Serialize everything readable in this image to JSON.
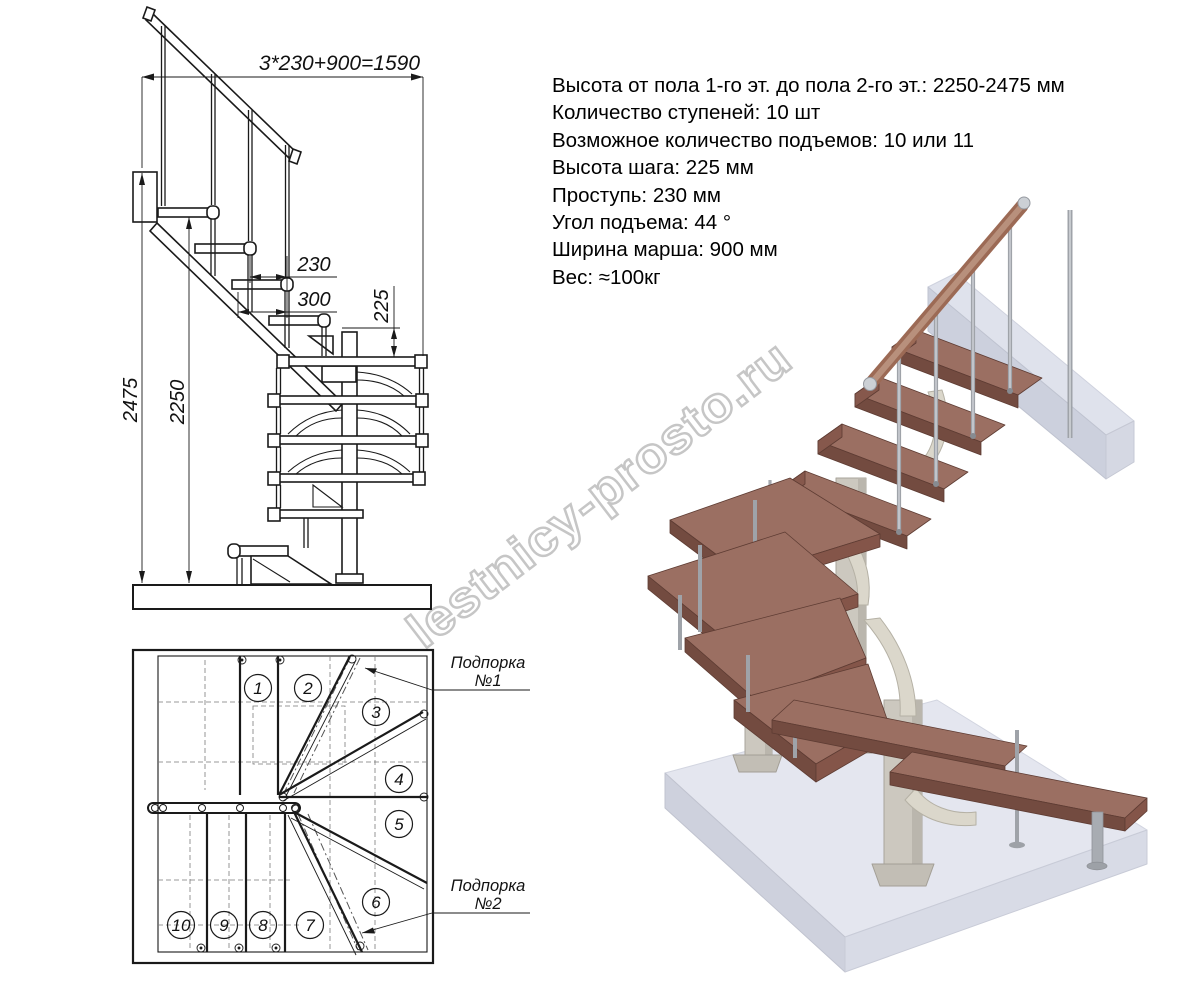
{
  "specs": {
    "lines": [
      "Высота от пола 1-го эт. до пола 2-го эт.: 2250-2475 мм",
      "Количество ступеней: 10 шт",
      "Возможное количество подъемов: 10 или 11",
      "Высота шага: 225 мм",
      "Проступь: 230 мм",
      "Угол подъема: 44 °",
      "Ширина марша: 900 мм",
      "Вес: ≈100кг"
    ]
  },
  "elevation": {
    "dims": {
      "total_run": "3*230+900=1590",
      "tread_depth": "230",
      "step_width": "300",
      "rise": "225",
      "height_max": "2475",
      "height_min": "2250"
    }
  },
  "plan": {
    "steps": [
      "1",
      "2",
      "3",
      "4",
      "5",
      "6",
      "7",
      "8",
      "9",
      "10"
    ],
    "support1": {
      "line1": "Подпорка",
      "line2": "№1"
    },
    "support2": {
      "line1": "Подпорка",
      "line2": "№2"
    }
  },
  "watermark": {
    "text": "lestnicy-prosto.ru"
  },
  "colors": {
    "line": "#1a1a1a",
    "wood_top": "#9b6f62",
    "wood_front": "#734b40",
    "handrail_wood": "#9c6a55",
    "metal": "#a0a4aa",
    "post": "#ccc8bf",
    "floor_top": "#e4e6ef",
    "floor_front": "#ced1dd",
    "watermark_gray": "#c8c8c8"
  }
}
